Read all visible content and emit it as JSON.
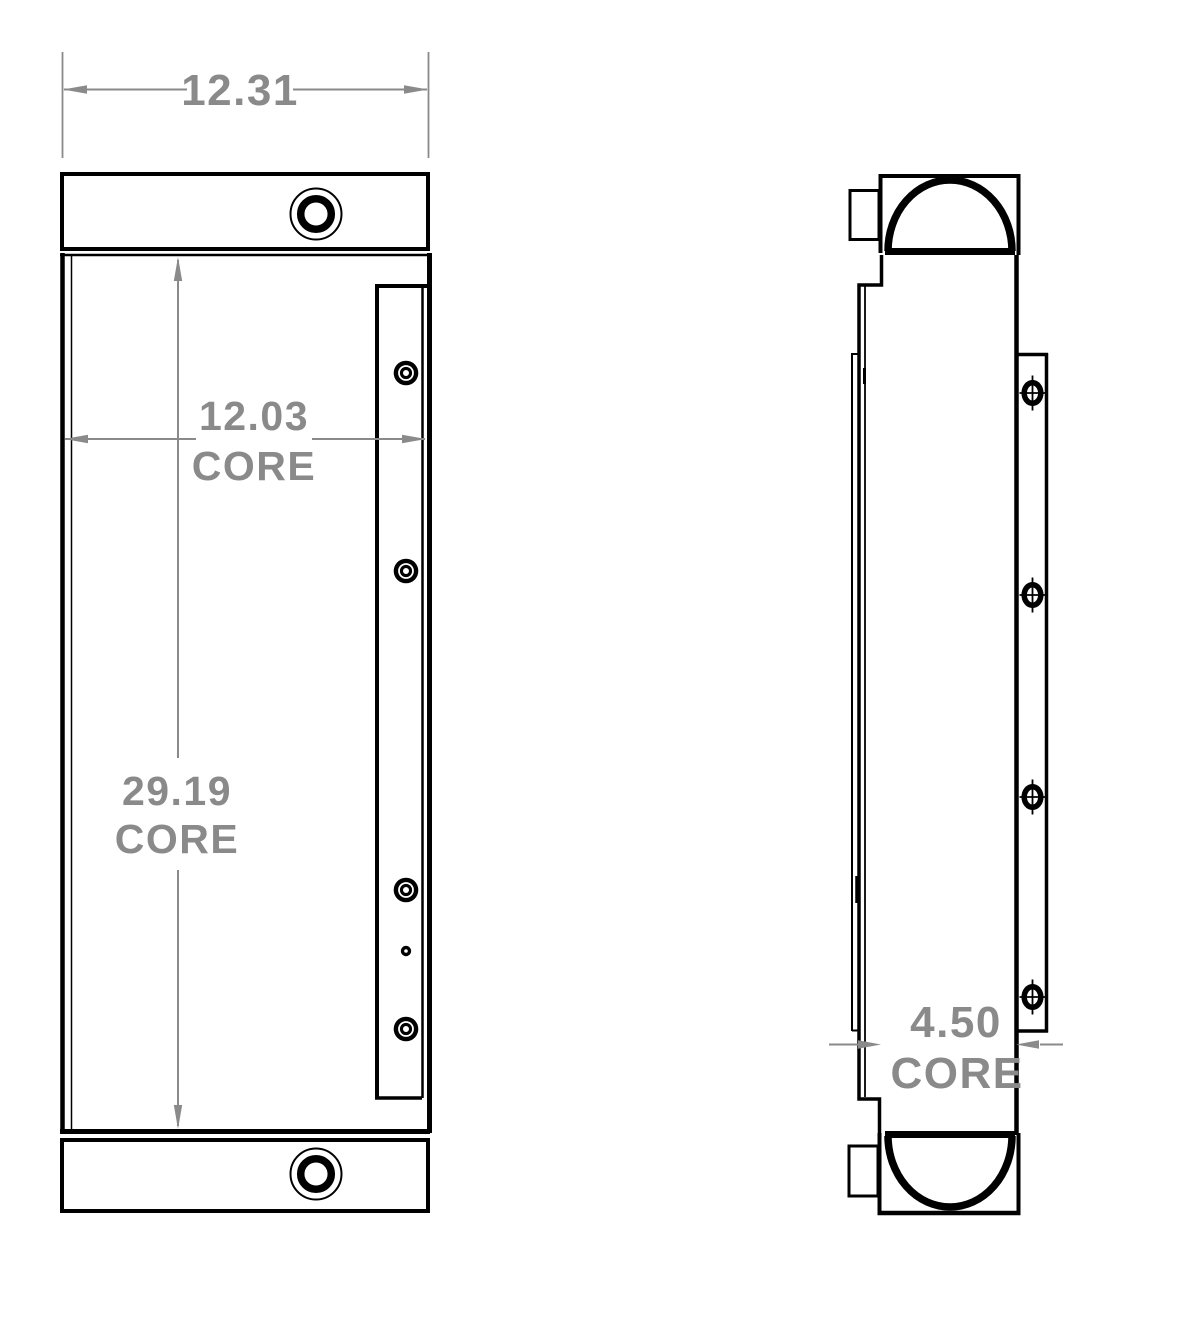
{
  "colors": {
    "line": "#000000",
    "dimension": "#8a8a8a",
    "background": "#ffffff"
  },
  "dimensions": {
    "overall_width": {
      "value": "12.31",
      "label": ""
    },
    "core_width": {
      "value": "12.03",
      "label": "CORE"
    },
    "core_height": {
      "value": "29.19",
      "label": "CORE"
    },
    "core_depth": {
      "value": "4.50",
      "label": "CORE"
    }
  }
}
